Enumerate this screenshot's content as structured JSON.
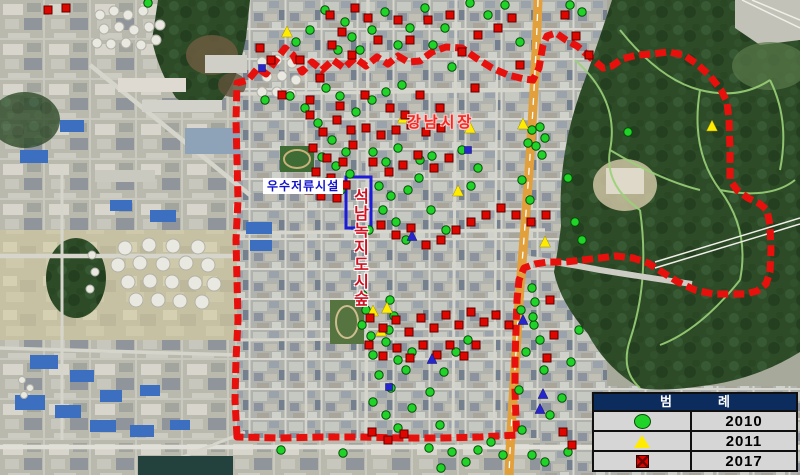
{
  "labels": {
    "stormwater_facility": "우수저류시설",
    "market": "강남시장",
    "urban_forest_vertical": "석남녹지도시숲"
  },
  "legend": {
    "title_left": "범",
    "title_right": "례",
    "rows": [
      {
        "symbol": "green-circle",
        "year": "2010"
      },
      {
        "symbol": "yellow-triangle",
        "year": "2011"
      },
      {
        "symbol": "red-square",
        "year": "2017"
      }
    ]
  },
  "colors": {
    "boundary": "#e8100c",
    "marker_green": "#1fd328",
    "marker_green_edge": "#064d06",
    "marker_yellow": "#ffec00",
    "marker_red": "#df0600",
    "marker_red_edge": "#5e0000",
    "marker_blue": "#2626cc",
    "highlight_box": "#1b1bd8",
    "legend_header_bg": "#0d2c5e"
  },
  "highlight_rect": {
    "x": 346,
    "y": 177,
    "width": 25,
    "height": 51
  },
  "boundary": {
    "path": "M 237,437 L 235,400 236,360 238,320 237,280 236,240 238,200 237,160 236,120 237,83 248,80 258,68 266,74 276,60 285,48 293,55 302,72 312,62 322,70 333,60 344,68 355,58 366,66 377,57 388,64 398,56 408,62 420,61 432,52 446,47 462,48 476,58 492,68 508,75 524,79 533,80 539,68 543,45 547,36 556,33 566,40 577,46 590,57 603,68 612,66 622,59 637,55 652,54 668,52 684,55 697,64 710,76 721,90 727,102 729,120 730,150 730,180 737,190 748,198 760,204 767,210 770,225 771,250 770,272 766,284 757,291 745,294 730,294 713,294 695,290 678,282 662,272 648,263 633,258 616,256 600,258 583,260 565,262 548,262 535,264 524,268 519,280 517,300 516,330 515,360 515,390 516,420 517,435 480,437 440,438 400,438 360,437 320,437 280,438 237,437 Z"
  },
  "markers": {
    "green": [
      [
        148,
        3
      ],
      [
        325,
        10
      ],
      [
        345,
        22
      ],
      [
        352,
        37
      ],
      [
        338,
        50
      ],
      [
        310,
        30
      ],
      [
        296,
        42
      ],
      [
        360,
        50
      ],
      [
        372,
        30
      ],
      [
        385,
        12
      ],
      [
        398,
        45
      ],
      [
        410,
        28
      ],
      [
        425,
        8
      ],
      [
        433,
        45
      ],
      [
        445,
        28
      ],
      [
        452,
        67
      ],
      [
        470,
        3
      ],
      [
        488,
        15
      ],
      [
        505,
        5
      ],
      [
        520,
        42
      ],
      [
        570,
        5
      ],
      [
        582,
        12
      ],
      [
        265,
        100
      ],
      [
        290,
        96
      ],
      [
        305,
        108
      ],
      [
        326,
        88
      ],
      [
        340,
        96
      ],
      [
        356,
        112
      ],
      [
        372,
        100
      ],
      [
        386,
        92
      ],
      [
        402,
        85
      ],
      [
        318,
        123
      ],
      [
        332,
        140
      ],
      [
        346,
        152
      ],
      [
        322,
        157
      ],
      [
        336,
        166
      ],
      [
        350,
        174
      ],
      [
        327,
        182
      ],
      [
        341,
        190
      ],
      [
        373,
        152
      ],
      [
        386,
        162
      ],
      [
        398,
        148
      ],
      [
        379,
        186
      ],
      [
        391,
        196
      ],
      [
        383,
        210
      ],
      [
        396,
        222
      ],
      [
        408,
        190
      ],
      [
        369,
        230
      ],
      [
        406,
        240
      ],
      [
        420,
        160
      ],
      [
        432,
        156
      ],
      [
        419,
        178
      ],
      [
        431,
        210
      ],
      [
        446,
        230
      ],
      [
        462,
        150
      ],
      [
        478,
        168
      ],
      [
        471,
        186
      ],
      [
        532,
        130
      ],
      [
        540,
        127
      ],
      [
        545,
        138
      ],
      [
        536,
        146
      ],
      [
        542,
        155
      ],
      [
        528,
        143
      ],
      [
        522,
        180
      ],
      [
        530,
        200
      ],
      [
        628,
        132
      ],
      [
        568,
        178
      ],
      [
        363,
        295
      ],
      [
        366,
        310
      ],
      [
        362,
        325
      ],
      [
        371,
        336
      ],
      [
        390,
        300
      ],
      [
        394,
        316
      ],
      [
        389,
        330
      ],
      [
        373,
        355
      ],
      [
        386,
        342
      ],
      [
        398,
        360
      ],
      [
        379,
        375
      ],
      [
        412,
        352
      ],
      [
        406,
        370
      ],
      [
        391,
        388
      ],
      [
        373,
        402
      ],
      [
        386,
        415
      ],
      [
        398,
        428
      ],
      [
        412,
        408
      ],
      [
        430,
        392
      ],
      [
        444,
        372
      ],
      [
        456,
        352
      ],
      [
        468,
        340
      ],
      [
        440,
        425
      ],
      [
        429,
        448
      ],
      [
        452,
        452
      ],
      [
        466,
        462
      ],
      [
        478,
        450
      ],
      [
        491,
        442
      ],
      [
        503,
        455
      ],
      [
        522,
        430
      ],
      [
        519,
        390
      ],
      [
        526,
        352
      ],
      [
        540,
        340
      ],
      [
        521,
        310
      ],
      [
        534,
        325
      ],
      [
        544,
        370
      ],
      [
        550,
        415
      ],
      [
        562,
        398
      ],
      [
        571,
        362
      ],
      [
        579,
        330
      ],
      [
        532,
        455
      ],
      [
        545,
        462
      ],
      [
        568,
        452
      ],
      [
        281,
        450
      ],
      [
        343,
        453
      ],
      [
        441,
        468
      ],
      [
        532,
        288
      ],
      [
        535,
        302
      ],
      [
        533,
        317
      ],
      [
        575,
        222
      ],
      [
        582,
        240
      ]
    ],
    "yellow": [
      [
        287,
        33
      ],
      [
        403,
        119
      ],
      [
        470,
        129
      ],
      [
        523,
        125
      ],
      [
        458,
        192
      ],
      [
        545,
        243
      ],
      [
        712,
        127
      ],
      [
        387,
        309
      ],
      [
        381,
        332
      ],
      [
        373,
        312
      ]
    ],
    "red": [
      [
        48,
        10
      ],
      [
        66,
        8
      ],
      [
        330,
        15
      ],
      [
        355,
        8
      ],
      [
        368,
        18
      ],
      [
        342,
        32
      ],
      [
        332,
        45
      ],
      [
        352,
        55
      ],
      [
        378,
        40
      ],
      [
        398,
        20
      ],
      [
        410,
        40
      ],
      [
        260,
        48
      ],
      [
        271,
        60
      ],
      [
        300,
        60
      ],
      [
        320,
        78
      ],
      [
        282,
        95
      ],
      [
        310,
        100
      ],
      [
        340,
        106
      ],
      [
        365,
        95
      ],
      [
        390,
        108
      ],
      [
        405,
        115
      ],
      [
        428,
        20
      ],
      [
        450,
        15
      ],
      [
        462,
        52
      ],
      [
        478,
        35
      ],
      [
        498,
        28
      ],
      [
        512,
        18
      ],
      [
        420,
        95
      ],
      [
        440,
        108
      ],
      [
        475,
        88
      ],
      [
        520,
        65
      ],
      [
        565,
        15
      ],
      [
        576,
        36
      ],
      [
        589,
        55
      ],
      [
        310,
        115
      ],
      [
        323,
        132
      ],
      [
        337,
        120
      ],
      [
        351,
        130
      ],
      [
        313,
        148
      ],
      [
        327,
        158
      ],
      [
        343,
        162
      ],
      [
        353,
        145
      ],
      [
        316,
        172
      ],
      [
        331,
        178
      ],
      [
        346,
        185
      ],
      [
        309,
        190
      ],
      [
        321,
        196
      ],
      [
        337,
        198
      ],
      [
        366,
        128
      ],
      [
        381,
        135
      ],
      [
        396,
        130
      ],
      [
        411,
        125
      ],
      [
        426,
        132
      ],
      [
        441,
        128
      ],
      [
        373,
        162
      ],
      [
        389,
        172
      ],
      [
        403,
        165
      ],
      [
        418,
        155
      ],
      [
        434,
        168
      ],
      [
        449,
        158
      ],
      [
        381,
        225
      ],
      [
        396,
        235
      ],
      [
        411,
        228
      ],
      [
        426,
        245
      ],
      [
        441,
        240
      ],
      [
        456,
        230
      ],
      [
        471,
        222
      ],
      [
        486,
        215
      ],
      [
        501,
        208
      ],
      [
        516,
        215
      ],
      [
        531,
        222
      ],
      [
        546,
        215
      ],
      [
        370,
        318
      ],
      [
        383,
        328
      ],
      [
        396,
        320
      ],
      [
        409,
        332
      ],
      [
        421,
        318
      ],
      [
        434,
        328
      ],
      [
        446,
        315
      ],
      [
        459,
        325
      ],
      [
        471,
        312
      ],
      [
        484,
        322
      ],
      [
        496,
        315
      ],
      [
        509,
        325
      ],
      [
        369,
        345
      ],
      [
        383,
        356
      ],
      [
        397,
        348
      ],
      [
        410,
        358
      ],
      [
        423,
        345
      ],
      [
        437,
        355
      ],
      [
        450,
        345
      ],
      [
        464,
        356
      ],
      [
        476,
        345
      ],
      [
        550,
        300
      ],
      [
        554,
        335
      ],
      [
        547,
        358
      ],
      [
        372,
        432
      ],
      [
        388,
        440
      ],
      [
        404,
        434
      ],
      [
        563,
        432
      ],
      [
        572,
        445
      ]
    ],
    "blue_triangles": [
      [
        432,
        360
      ],
      [
        523,
        321
      ],
      [
        543,
        395
      ],
      [
        540,
        410
      ],
      [
        412,
        237
      ]
    ],
    "blue_squares": [
      [
        468,
        150
      ],
      [
        262,
        68
      ],
      [
        389,
        387
      ]
    ]
  }
}
